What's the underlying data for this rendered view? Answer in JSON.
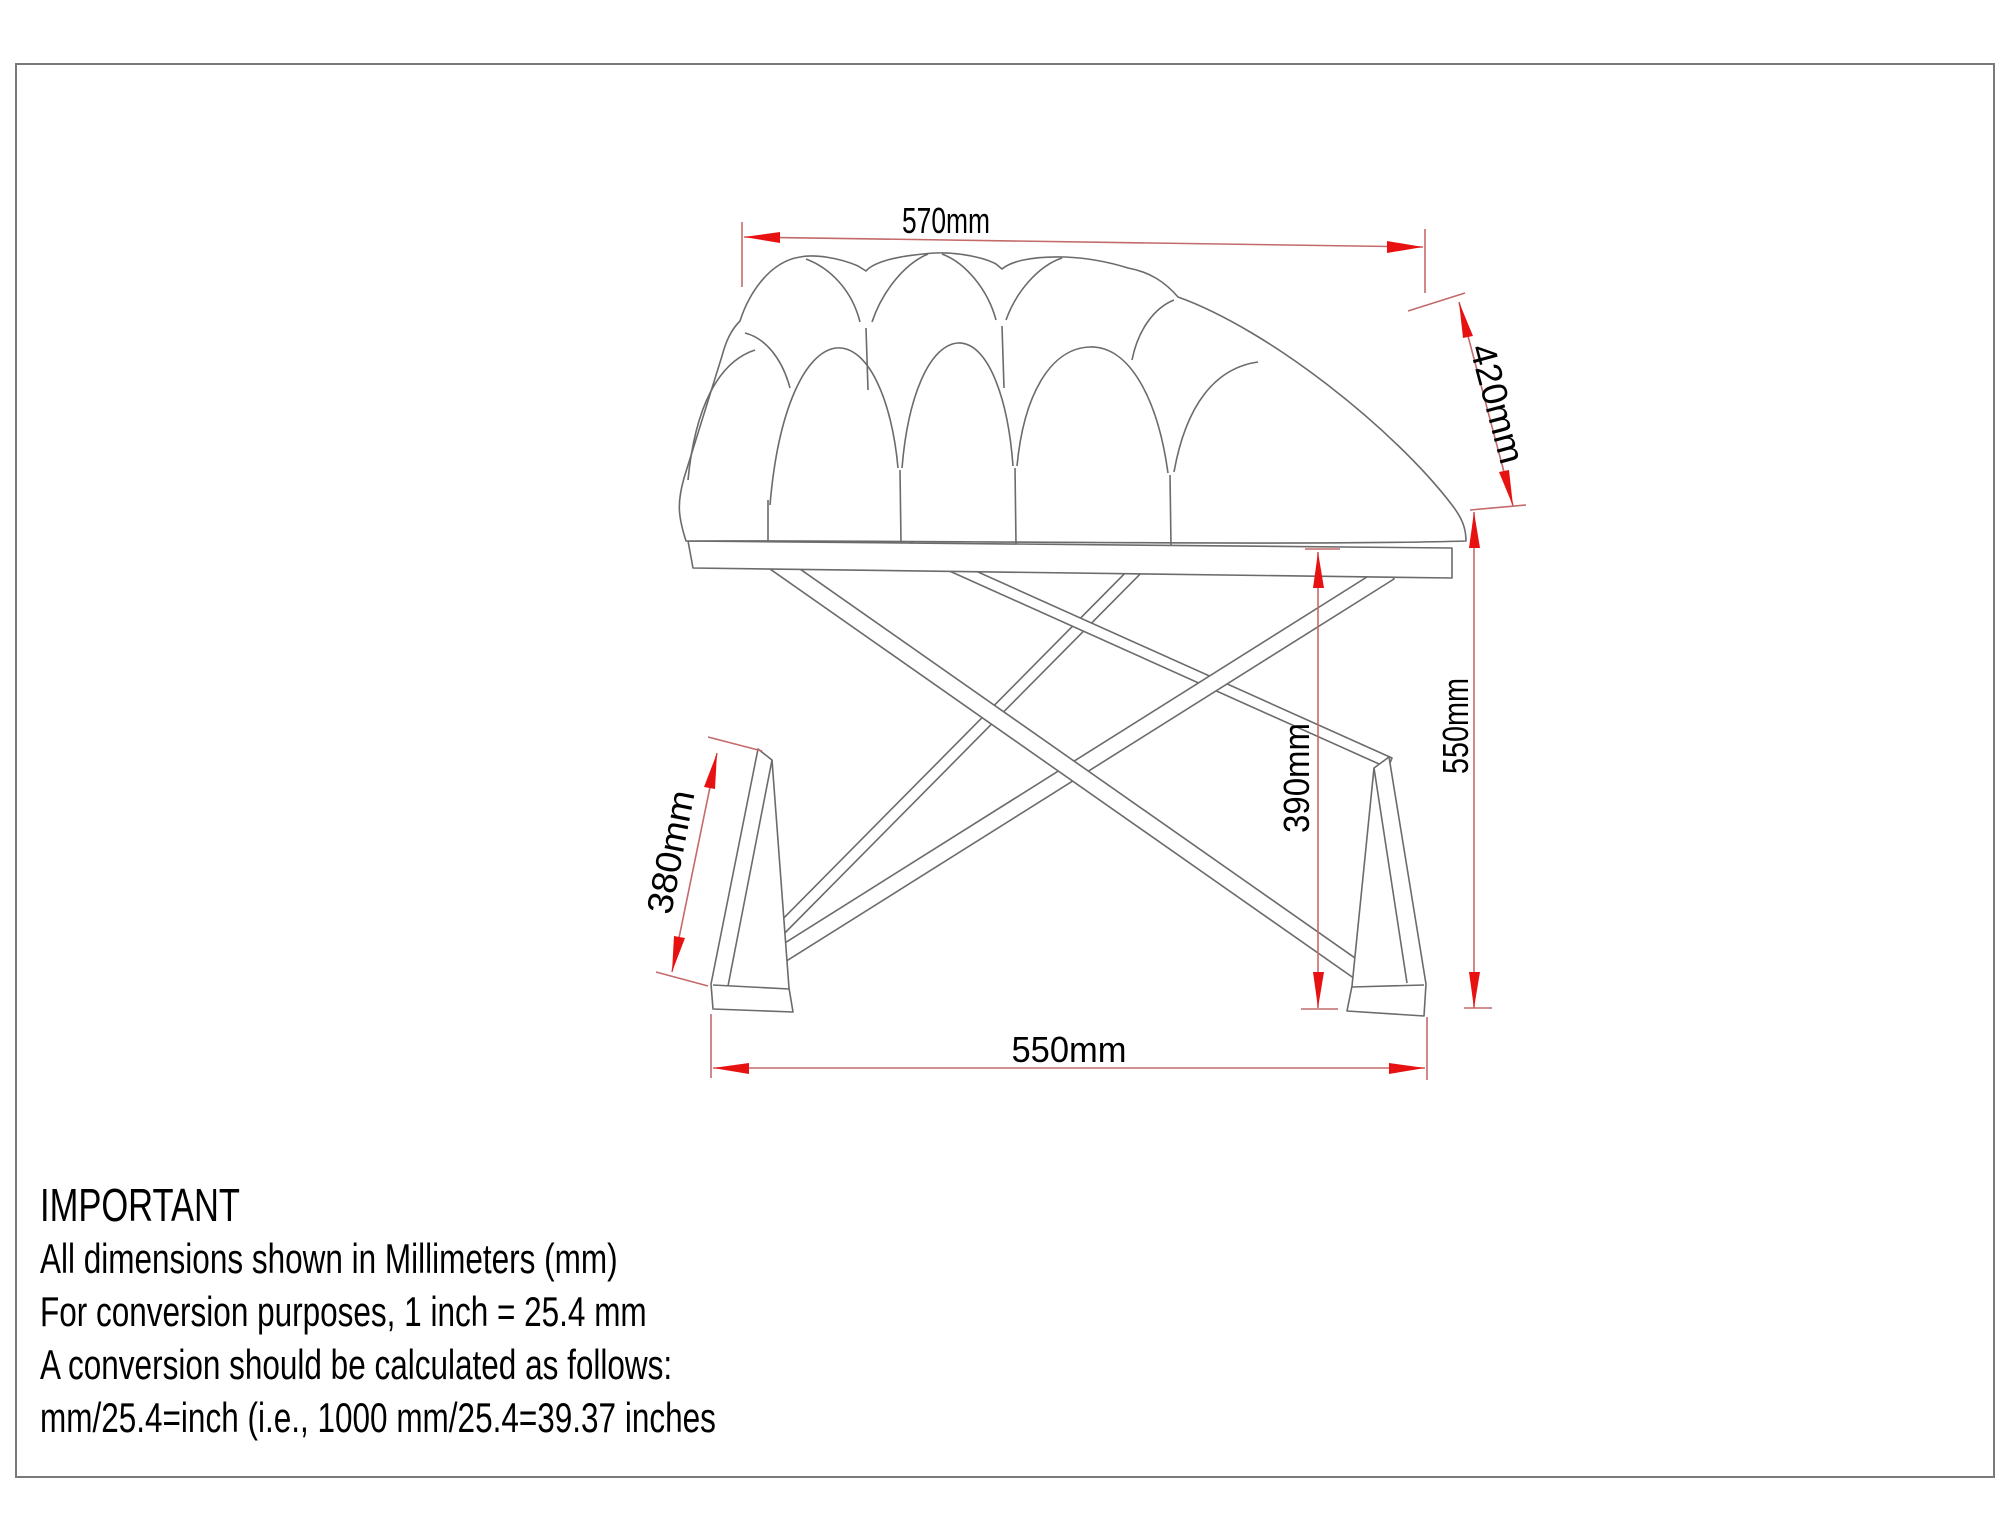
{
  "figure": {
    "description": "Technical line drawing of a button-tufted bench seat on an X-shaped base, annotated with millimeter dimensions"
  },
  "dimensions": {
    "top_width": "570mm",
    "seat_depth": "420mm",
    "overall_height": "550mm",
    "underseat_height": "390mm",
    "foot_length": "380mm",
    "base_width": "550mm"
  },
  "note": {
    "heading": "IMPORTANT",
    "lines": [
      "All dimensions shown in Millimeters (mm)",
      "For conversion purposes, 1 inch = 25.4 mm",
      "A conversion should be calculated as follows:",
      "mm/25.4=inch (i.e., 1000 mm/25.4=39.37 inches"
    ]
  },
  "colors": {
    "background": "#ffffff",
    "border": "#7a7a7a",
    "drawing_line": "#6b6b6b",
    "dimension_line": "#c46a6a",
    "arrowhead": "#e81111",
    "text": "#000000"
  }
}
